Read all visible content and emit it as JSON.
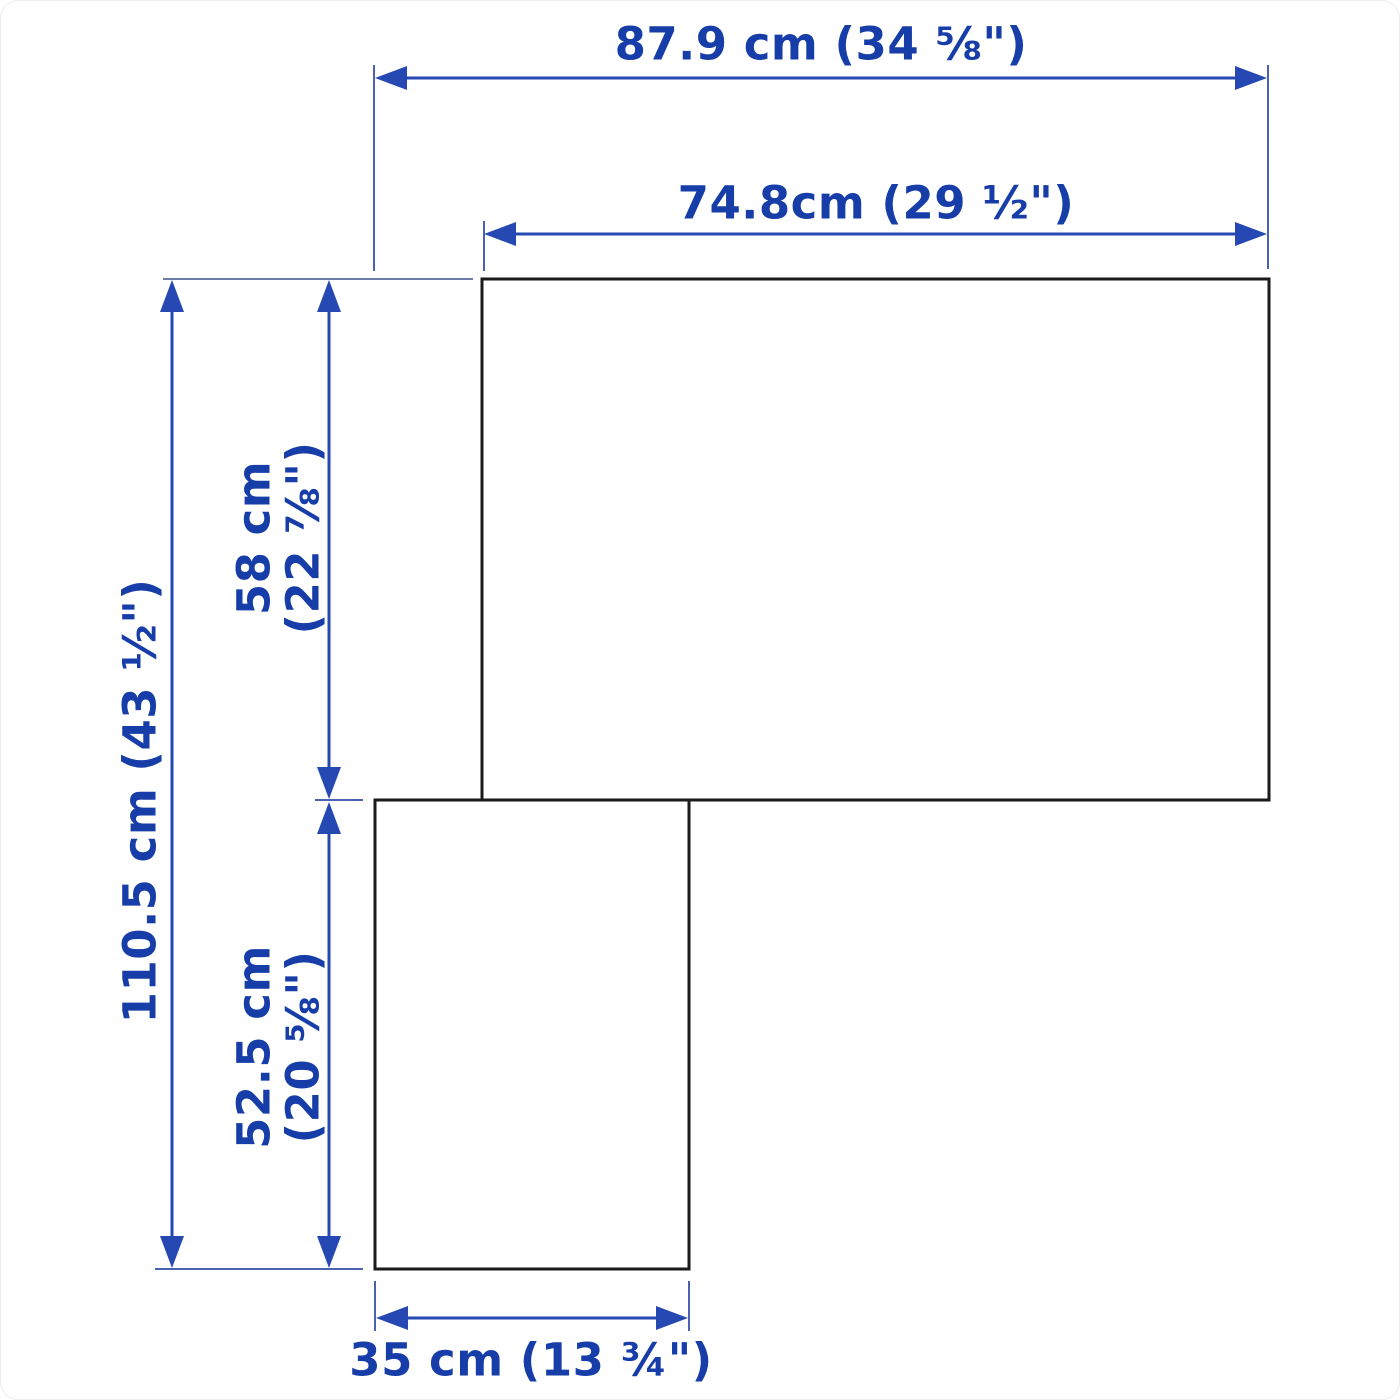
{
  "diagram": {
    "kind": "furniture-dimension-drawing",
    "shape": "L-shaped corner unit, front view",
    "labels": {
      "total_width": "87.9 cm (34 ⅝\")",
      "upper_width": "74.8cm (29 ½\")",
      "total_height": "110.5 cm (43 ½\")",
      "upper_height_cm": "58 cm",
      "upper_height_in": "(22 ⅞\")",
      "lower_height_cm": "52.5 cm",
      "lower_height_in": "(20 ⅝\")",
      "lower_width": "35 cm (13 ¾\")"
    },
    "measurements": [
      {
        "id": "total-width",
        "cm": 87.9,
        "inches": "34 ⅝"
      },
      {
        "id": "upper-width",
        "cm": 74.8,
        "inches": "29 ½"
      },
      {
        "id": "total-height",
        "cm": 110.5,
        "inches": "43 ½"
      },
      {
        "id": "upper-height",
        "cm": 58,
        "inches": "22 ⅞"
      },
      {
        "id": "lower-height",
        "cm": 52.5,
        "inches": "20 ⅝"
      },
      {
        "id": "lower-width",
        "cm": 35,
        "inches": "13 ¾"
      }
    ],
    "colors": {
      "dimension_text": "#163da8",
      "dimension_line": "#2548b2",
      "extension_line": "#4a63b0",
      "extension_line_muted": "#6c7ca6",
      "outline": "#1a1a1a",
      "background": "#ffffff"
    }
  }
}
